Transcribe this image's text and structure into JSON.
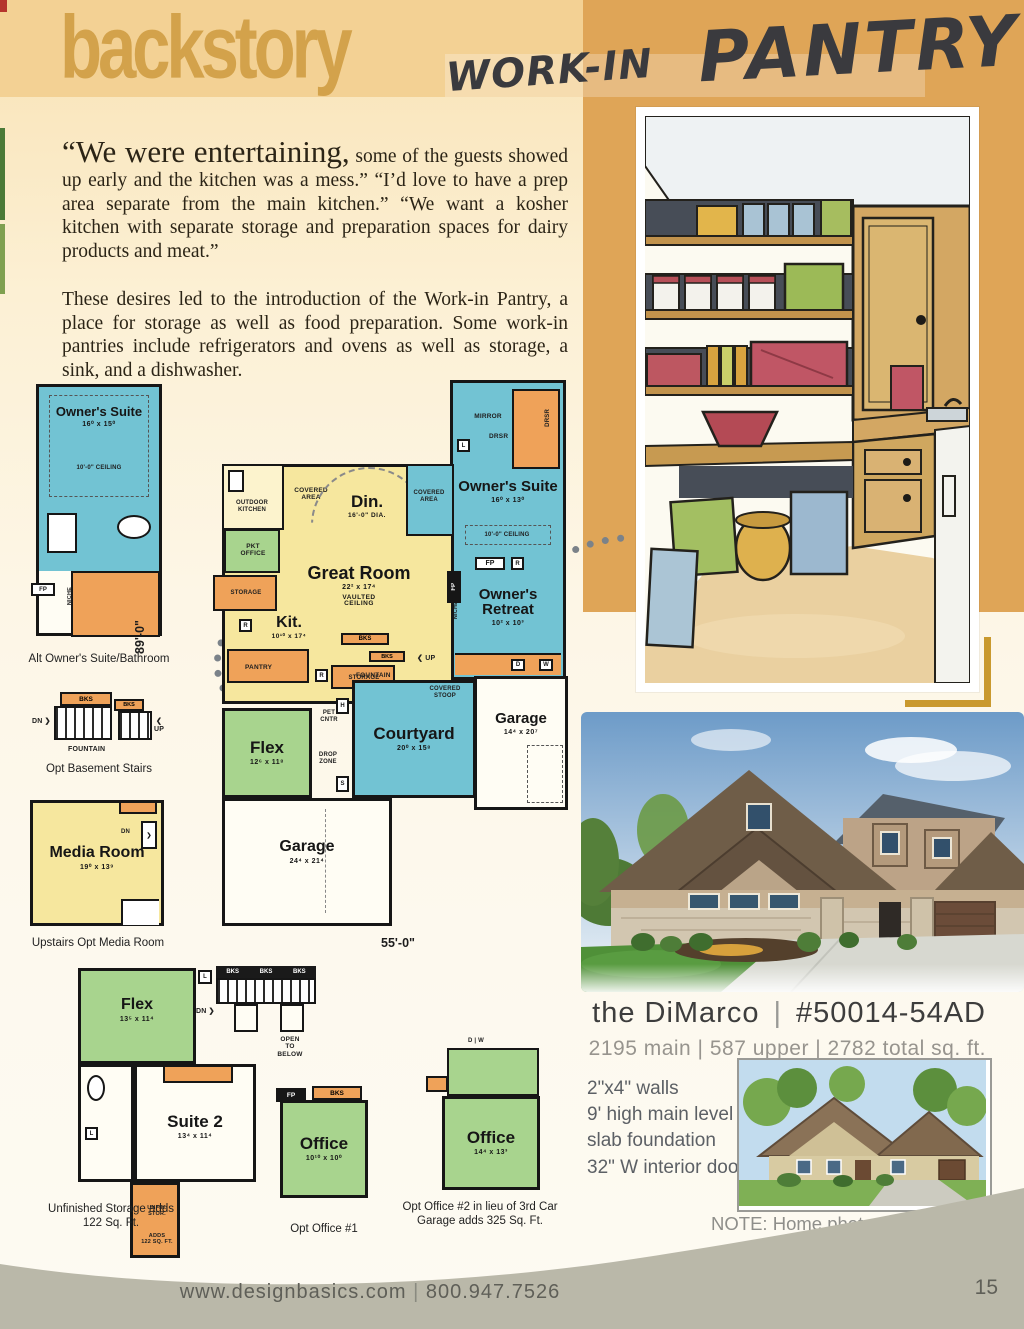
{
  "header": {
    "brand": "backstory",
    "script_small": "WORK-IN",
    "script_large": "PANTRY"
  },
  "intro": {
    "lead": "“We were entertaining,",
    "p1_rest": " some of the guests showed up early and the kitchen was a mess.”  “I’d love to have a prep area separate from the main kitchen.” “We want a kosher kitchen with separate storage and preparation spaces for dairy products and meat.”",
    "p2": "These desires led to the introduction of the Work-in Pantry, a place for storage as well as food preparation. Some work-in pantries include refrigerators and ovens as well as storage, a sink, and a dishwasher."
  },
  "rooms": {
    "owners_suite_alt": {
      "name": "Owner's Suite",
      "dims": "16⁰ x 15⁰"
    },
    "owners_suite": {
      "name": "Owner's Suite",
      "dims": "16⁰ x 13⁰"
    },
    "owners_retreat": {
      "name": "Owner's Retreat",
      "dims": "10² x 10³"
    },
    "din": {
      "name": "Din.",
      "dims": "16'-0\" DIA."
    },
    "great_room": {
      "name": "Great Room",
      "dims": "22² x 17⁴"
    },
    "kit": {
      "name": "Kit.",
      "dims": "10¹⁰ x 17⁴"
    },
    "flex_main": {
      "name": "Flex",
      "dims": "12⁶ x 11⁸"
    },
    "courtyard": {
      "name": "Courtyard",
      "dims": "20⁰ x 15⁸"
    },
    "garage_side": {
      "name": "Garage",
      "dims": "14⁴ x 20⁷"
    },
    "garage_main": {
      "name": "Garage",
      "dims": "24⁴ x 21⁴"
    },
    "media": {
      "name": "Media Room",
      "dims": "19⁰ x 13⁹"
    },
    "flex_upper": {
      "name": "Flex",
      "dims": "13⁵ x 11⁴"
    },
    "suite2": {
      "name": "Suite 2",
      "dims": "13⁴ x 11⁴"
    },
    "office1": {
      "name": "Office",
      "dims": "10¹⁰ x 10⁰"
    },
    "office2": {
      "name": "Office",
      "dims": "14⁴ x 13³"
    }
  },
  "lbl": {
    "mirror": "MIRROR",
    "drsr": "DRSR",
    "niche": "NICHE",
    "fp": "FP",
    "bks": "BKS",
    "up": "UP",
    "dn": "DN",
    "l": "L",
    "r": "R",
    "h": "H",
    "s": "S",
    "d": "D",
    "w": "W",
    "storage": "STORAGE",
    "pantry": "PANTRY",
    "fountain": "FOUNTAIN",
    "covered_area": "COVERED\nAREA",
    "covered_stoop": "COVERED\nSTOOP",
    "outdoor_kitchen": "OUTDOOR\nKITCHEN",
    "pkt_office": "PKT\nOFFICE",
    "pet_cntr": "PET\nCNTR",
    "drop_zone": "DROP\nZONE",
    "open_below": "OPEN\nTO\nBELOW",
    "ceiling_10": "10'-0\" CEILING",
    "vaulted": "VAULTED\nCEILING",
    "unfin_stor": "UNFIN.\nSTOR.",
    "unfin_adds": "ADDS\n122 SQ. FT.",
    "chev_l": "❮",
    "chev_r": "❯"
  },
  "plan_dims": {
    "width": "55'-0\"",
    "height": "89'-0\""
  },
  "captions": {
    "alt_owners": "Alt Owner's Suite/Bathroom",
    "basement": "Opt Basement Stairs",
    "media": "Upstairs Opt Media Room",
    "unfin_storage": "Unfinished Storage adds 122 Sq. Ft.",
    "office1": "Opt Office #1",
    "office2": "Opt Office #2 in lieu of 3rd Car Garage adds 325 Sq. Ft."
  },
  "product": {
    "name": "the DiMarco",
    "sep": "|",
    "plan_number": "#50014-54AD",
    "sqft": "2195 main | 587 upper | 2782 total sq. ft.",
    "specs": [
      "2\"x4\" walls",
      "9' high main level",
      "slab foundation",
      "32\" W interior doors"
    ],
    "note_line1": "NOTE: Home photographed above may",
    "note_line2": "have been altered from original design."
  },
  "footer": {
    "url": "www.designbasics.com",
    "sep": "|",
    "phone": "800.947.7526",
    "page": "15"
  },
  "colors": {
    "accent_gold": "#dfa557",
    "room_blue": "#72c3d3",
    "room_yellow": "#f6e79e",
    "room_orange": "#efa259",
    "room_green": "#a8d48e",
    "footer_gray": "#bab8a9"
  }
}
